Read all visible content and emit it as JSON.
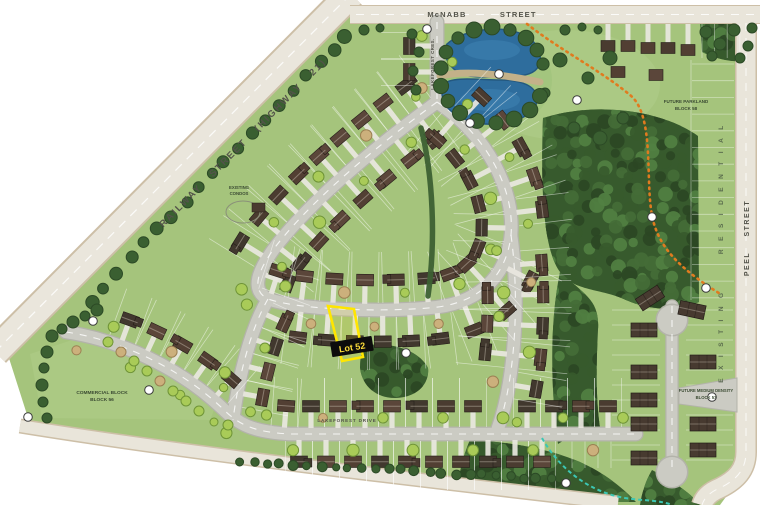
{
  "map": {
    "streets": {
      "railway": "RAILWAY STREET (HIGHWAY 21)",
      "mcnabb": "McNABB STREET",
      "peel": "PEEL STREET",
      "lakeforest_drive": "LAKEFOREST DRIVE",
      "lakeforest_cres": "LAKEFOREST CRES."
    },
    "areas": {
      "existing_residential": "EXISTING RESIDENTIAL",
      "existing_condos_l1": "EXISTING",
      "existing_condos_l2": "CONDOS",
      "commercial_l1": "COMMERCIAL BLOCK",
      "commercial_l2": "BLOCK 56",
      "parkland_l1": "FUTURE PARKLAND",
      "parkland_l2": "BLOCK 58",
      "medium_l1": "FUTURE MEDIUM DENSITY",
      "medium_l2": "BLOCK 57"
    },
    "highlight": {
      "lot_label": "Lot 52"
    },
    "colors": {
      "site_green": "#a5c47c",
      "forest": "#375a2d",
      "pond": "#2e6d9d",
      "road": "#cbcbc3",
      "boundary_road": "#e9e5da",
      "highlight": "#ffe400",
      "trail": "#e07b1f",
      "stream": "#3cc7b4"
    }
  }
}
